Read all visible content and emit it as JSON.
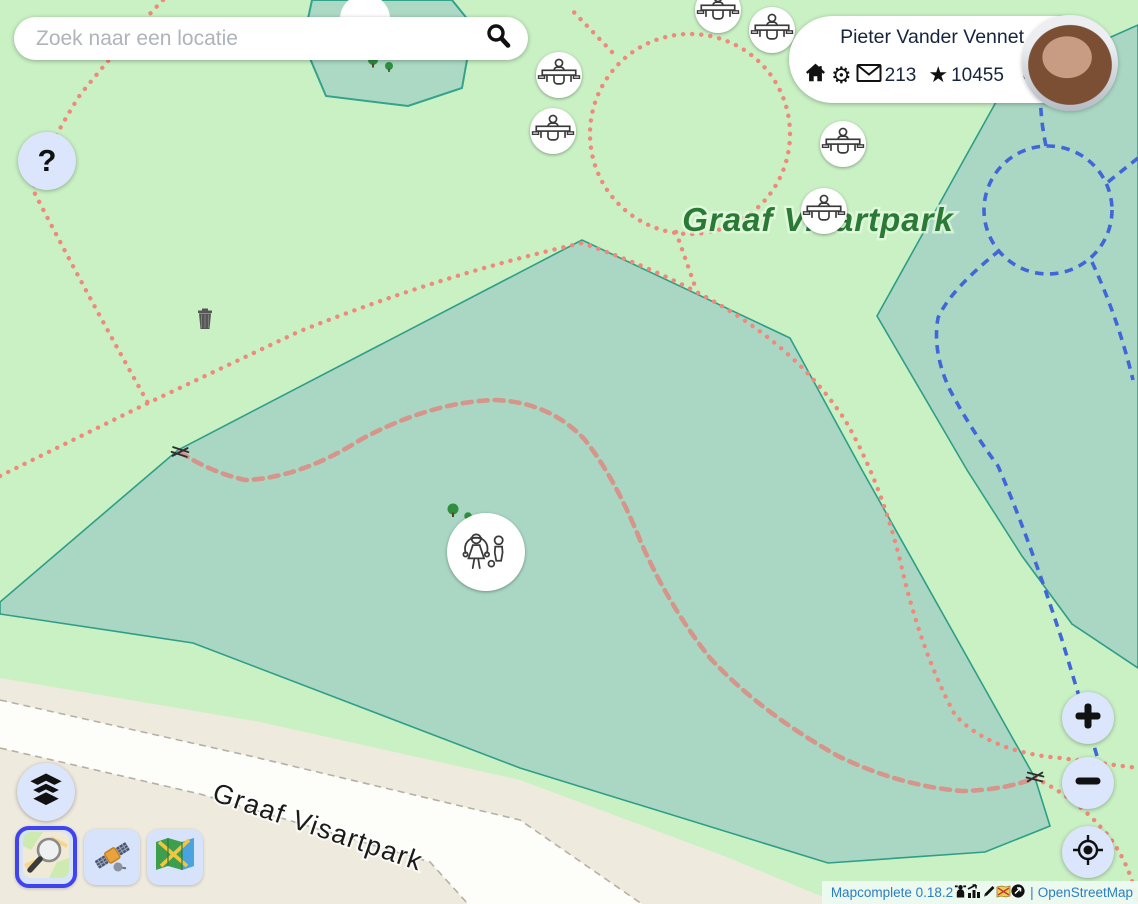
{
  "search": {
    "placeholder": "Zoek naar een locatie"
  },
  "user": {
    "name": "Pieter Vander Vennet",
    "message_count": "213",
    "star_count": "10455",
    "gear_glyph": "⚙",
    "star_glyph": "★"
  },
  "help": {
    "label": "?"
  },
  "map": {
    "park_label": "Graaf Visartpark",
    "street_label": "Graaf Visartpark",
    "markers": [
      {
        "type": "picnic-table"
      },
      {
        "type": "picnic-table"
      },
      {
        "type": "picnic-table"
      },
      {
        "type": "picnic-table"
      },
      {
        "type": "picnic-table"
      },
      {
        "type": "picnic-table"
      },
      {
        "type": "playground"
      }
    ]
  },
  "background_layers": [
    {
      "id": "osm-carto",
      "selected": true
    },
    {
      "id": "satellite",
      "selected": false
    },
    {
      "id": "folded-map",
      "selected": false
    }
  ],
  "attribution": {
    "app_name": "Mapcomplete",
    "version": "0.18.2",
    "separator": "|",
    "osm_label": "OpenStreetMap"
  },
  "colors": {
    "park_fill": "#c9f1c4",
    "scrub_fill": "#a9d7c3",
    "scrub_stroke": "#2f9e87",
    "path_red": "#f0897c",
    "path_blue": "#4066d8",
    "road_fill": "#efeade",
    "button_bg": "#dce6fb",
    "selected_layer_border": "#4143ee",
    "link_blue": "#2d7dc3",
    "park_label_green": "#2a7a35"
  }
}
